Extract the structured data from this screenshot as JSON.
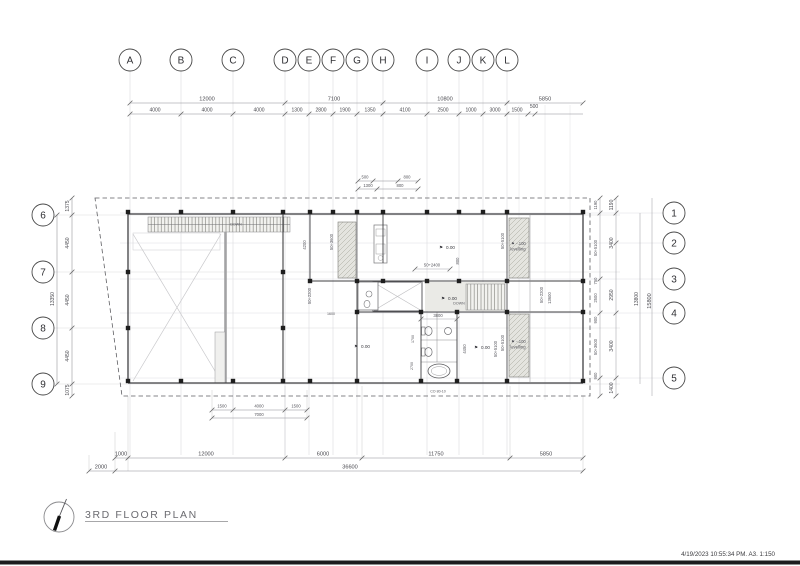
{
  "sheet": {
    "title": "3RD FLOOR PLAN",
    "stamp": "4/19/2023 10:55:34 PM. A3. 1:150"
  },
  "grid": {
    "columns": [
      "A",
      "B",
      "C",
      "D",
      "E",
      "F",
      "G",
      "H",
      "I",
      "J",
      "K",
      "L"
    ],
    "rows_left": [
      "6",
      "7",
      "8",
      "9"
    ],
    "rows_right": [
      "1",
      "2",
      "3",
      "4",
      "5"
    ]
  },
  "dims": {
    "top_major": [
      "12000",
      "7100",
      "10800",
      "5850"
    ],
    "top_minor": [
      "4000",
      "4000",
      "4000",
      "1300",
      "2800",
      "1900",
      "1350",
      "4100",
      "2500",
      "1000",
      "3000",
      "1500",
      "500"
    ],
    "mid_top": [
      "500",
      "800",
      "1300",
      "800"
    ],
    "left_minor": [
      "1375",
      "4450",
      "4450",
      "4450",
      "1075"
    ],
    "left_total": "13350",
    "right_minor": [
      "1190",
      "50÷5100",
      "750",
      "2500",
      "900",
      "50÷3600",
      "900"
    ],
    "right_major": [
      "1190",
      "3400",
      "2950",
      "3400",
      "1400"
    ],
    "right_totals": [
      "13800",
      "15800"
    ],
    "bottom_small": [
      "1500",
      "4000",
      "1500"
    ],
    "bottom_small_total": "7000",
    "bottom_major": [
      "1000",
      "12000",
      "6000",
      "11750",
      "5850"
    ],
    "bottom_total": "36600",
    "bottom_offset": "2000",
    "interior": [
      "50÷2400",
      "800",
      "3800",
      "50÷5100",
      "50÷5100",
      "50÷5100",
      "50÷2200",
      "4450",
      "1700",
      "2700",
      "1600",
      "50÷2200",
      "13600",
      "50÷3600",
      "4200"
    ]
  },
  "labels": {
    "level_flag": "⚑",
    "level_zero": "0.00",
    "level_neg": "-.100",
    "levelling": "levelling",
    "down": "DOWN",
    "drain": "CO 80-10"
  }
}
